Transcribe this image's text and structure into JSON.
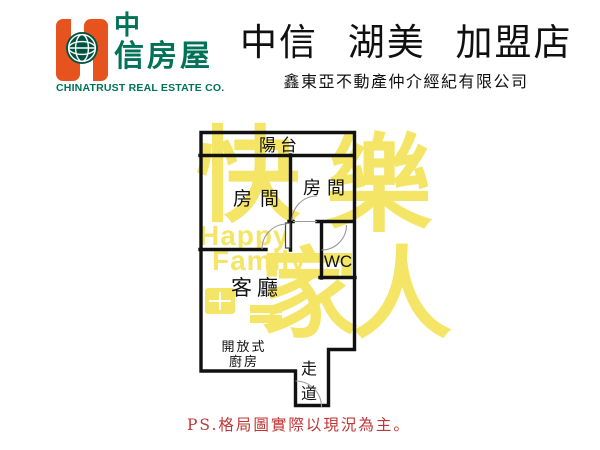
{
  "header": {
    "logo": {
      "zh_line1": "中",
      "zh_line2": "信房屋",
      "en_name": "CHINATRUST REAL ESTATE CO.",
      "orange": "#E6531E",
      "green": "#007257",
      "globe_green": "#00543F"
    },
    "title": "中信 湖美 加盟店",
    "subtitle": "鑫東亞不動產仲介經紀有限公司"
  },
  "floorplan": {
    "wall_color": "#111111",
    "door_arc_color": "#9a9a9a",
    "rooms": {
      "balcony": "陽台",
      "bedroom_left": "房間",
      "bedroom_right": "房間",
      "wc": "WC",
      "living_room": "客廳",
      "kitchen_line1": "開放式",
      "kitchen_line2": "廚房",
      "hallway_char1": "走",
      "hallway_char2": "道"
    }
  },
  "watermark": {
    "color": "#F5E567",
    "char1": "快",
    "char2": "樂",
    "word1": "Happy",
    "word2": "Family",
    "char3": "家",
    "char4": "人"
  },
  "footer": {
    "note": "PS.格局圖實際以現況為主。",
    "color": "#C23535"
  }
}
